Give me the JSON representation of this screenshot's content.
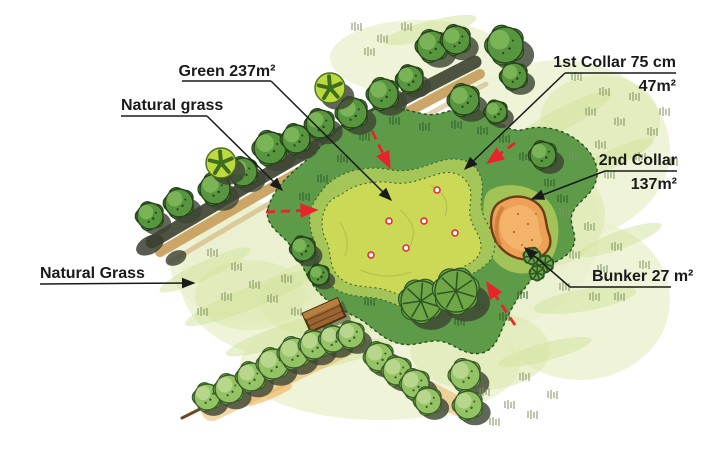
{
  "plan": {
    "labels": {
      "green": "Green 237m²",
      "natural_grass_top": "Natural grass",
      "first_collar_line1": "1st Collar 75 cm",
      "first_collar_line2": "47m²",
      "second_collar_line1": "2nd Collar",
      "second_collar_line2": "137m²",
      "bunker": "Bunker 27 m²",
      "natural_grass_bottom": "Natural Grass"
    },
    "features": {
      "green_area_m2": 237,
      "first_collar_width_cm": 75,
      "first_collar_area_m2": 47,
      "second_collar_area_m2": 137,
      "bunker_area_m2": 27,
      "hole_position_count": 6,
      "slope_arrow_count": 4
    },
    "colors": {
      "label_text": "#1a1a1a",
      "annotation_red": "#e8232b",
      "green_surface": "#ccd957",
      "green_contour": "#aebf4c",
      "first_collar": "#a4c558",
      "second_collar": "#5d9b49",
      "second_collar_edge": "#2c4d22",
      "surround_wash": "#e9f0cc",
      "surround_wash_deep": "#dce8ae",
      "streak_green": "#cfe39b",
      "bunker_sand": "#eda157",
      "bunker_sand_light": "#f4b66e",
      "bunker_edge": "#6e3c18",
      "tree_dark": "#57953f",
      "tree_dark_light": "#83bb5c",
      "tree_dark_edge": "#27431c",
      "tree_light": "#93c364",
      "tree_light_hi": "#c2dc96",
      "tree_light_edge": "#3a5c28",
      "tree_star": "#bcd93e",
      "tree_star_glyph": "#3f6d1f",
      "palm_green": "#6fa747",
      "palm_edge": "#2e5724",
      "shadow": "#3e4633",
      "path_tan": "#c79c59",
      "path_shadow": "#3b4030",
      "orange_wash": "#ecb057",
      "bench_wood": "#9a6532",
      "bench_edge": "#4e2f10",
      "tuft_pale": "#7f925f",
      "tuft_dark": "#2f5a28"
    }
  }
}
